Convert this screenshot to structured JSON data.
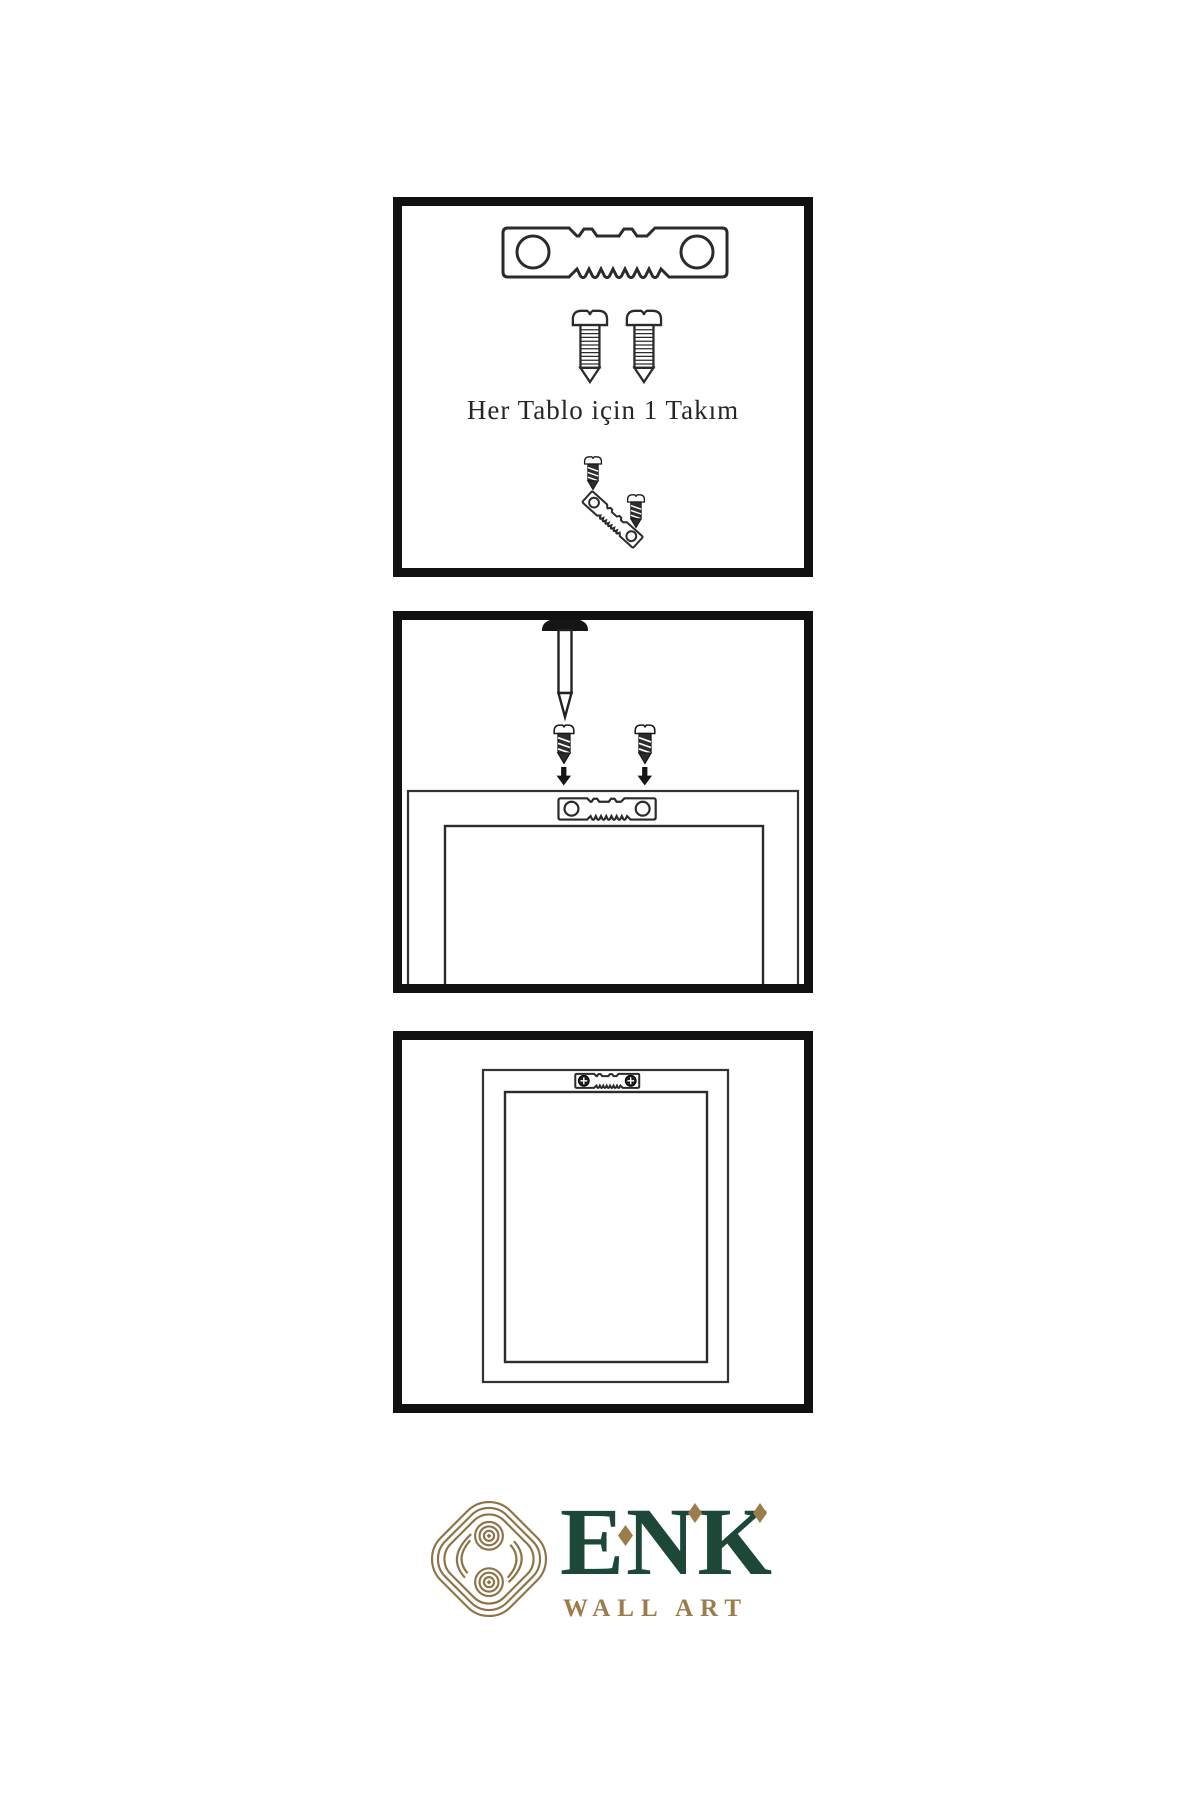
{
  "page": {
    "background": "#ffffff",
    "type": "wall-art-hanging-instructions"
  },
  "colors": {
    "line": "#2b2b2b",
    "panel_border": "#111111",
    "brand_green": "#1d4736",
    "brand_gold": "#9c7c4a",
    "knot_gold": "#8d7347"
  },
  "panels": [
    {
      "name": "step-1-hardware-kit",
      "caption": "Her Tablo için 1 Takım",
      "icons": [
        "sawtooth-hanger",
        "screw",
        "screw",
        "screw",
        "tilted-sawtooth-hanger",
        "screw"
      ]
    },
    {
      "name": "step-2-attach-hanger",
      "caption": "",
      "icons": [
        "wall-nail",
        "screw",
        "screw",
        "arrow-down",
        "arrow-down",
        "frame-back",
        "sawtooth-hanger"
      ]
    },
    {
      "name": "step-3-hanger-mounted",
      "caption": "",
      "icons": [
        "frame-back",
        "sawtooth-hanger-fastened",
        "phillips-screw-head",
        "phillips-screw-head"
      ]
    }
  ],
  "logo": {
    "brand": "ENK",
    "tagline": "WALL ART",
    "icon": "knot-logo"
  }
}
